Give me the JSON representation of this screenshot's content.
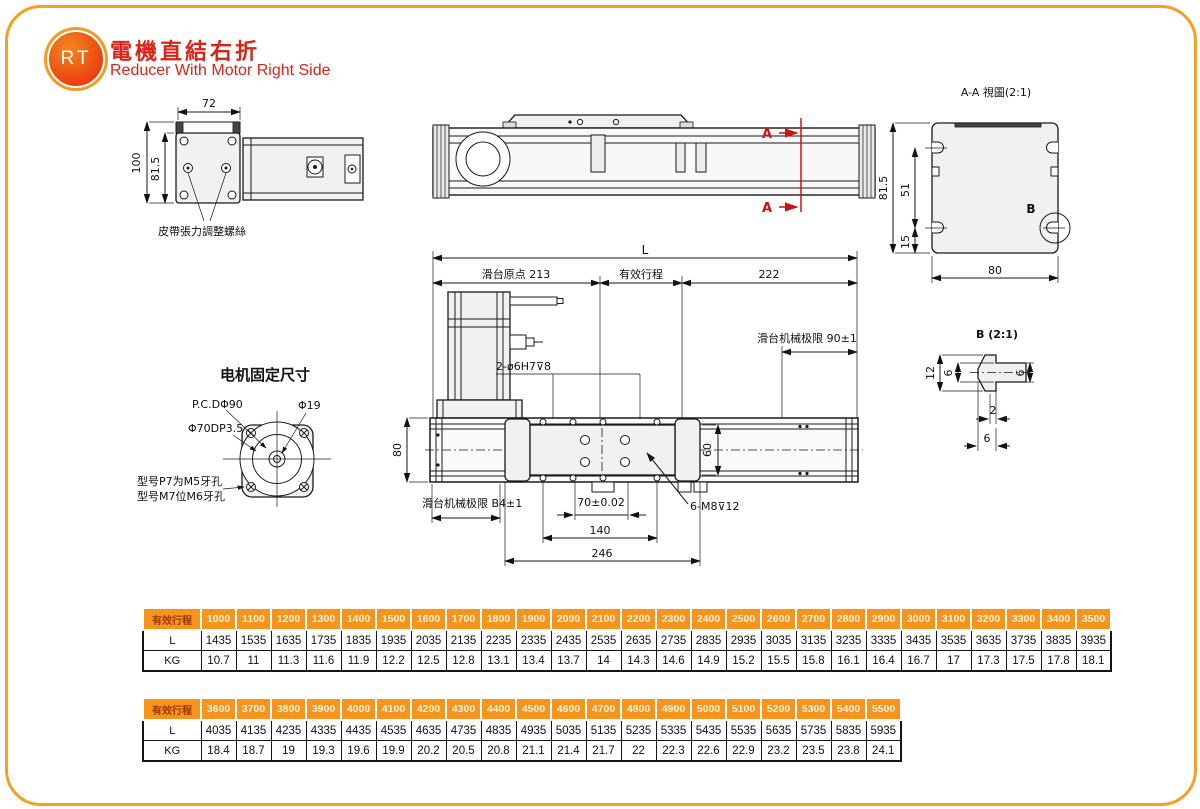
{
  "header": {
    "logo_text": "RT",
    "title_zh": "電機直結右折",
    "title_en": "Reducer With Motor Right Side"
  },
  "drawings": {
    "front": {
      "w": "72",
      "h": "100",
      "h2": "81.5",
      "belt": "皮帶張力調整螺絲"
    },
    "side": {
      "a": "A"
    },
    "aa": {
      "title": "A-A 視圖(2:1)",
      "h": "81.5",
      "d51": "51",
      "d15": "15",
      "w": "80",
      "b": "B"
    },
    "b": {
      "title": "B (2:1)",
      "d12": "12",
      "d6a": "6",
      "d6b": "6",
      "d2": "2",
      "d6c": "6"
    },
    "plan": {
      "L": "L",
      "origin": "滑台原点 213",
      "stroke": "有效行程",
      "d222": "222",
      "limit_right": "滑台机械极限 90±1",
      "limit_left": "滑台机械极限 B4±1",
      "pins": "2-ø6H7⊽8",
      "d80": "80",
      "d60": "60",
      "d70": "70±0.02",
      "d140": "140",
      "d246": "246",
      "screws": "6-M8⊽12"
    },
    "motor": {
      "title": "电机固定尺寸",
      "pcd": "P.C.DΦ90",
      "d19": "Φ19",
      "d70": "Φ70DP3.5",
      "note1": "型号P7为M5牙孔",
      "note2": "型号M7位M6牙孔"
    }
  },
  "tables": [
    {
      "header_label": "有效行程",
      "strokes": [
        "1000",
        "1100",
        "1200",
        "1300",
        "1400",
        "1500",
        "1600",
        "1700",
        "1800",
        "1900",
        "2000",
        "2100",
        "2200",
        "2300",
        "2400",
        "2500",
        "2600",
        "2700",
        "2800",
        "2900",
        "3000",
        "3100",
        "3200",
        "3300",
        "3400",
        "3500"
      ],
      "rows": [
        {
          "label": "L",
          "values": [
            "1435",
            "1535",
            "1635",
            "1735",
            "1835",
            "1935",
            "2035",
            "2135",
            "2235",
            "2335",
            "2435",
            "2535",
            "2635",
            "2735",
            "2835",
            "2935",
            "3035",
            "3135",
            "3235",
            "3335",
            "3435",
            "3535",
            "3635",
            "3735",
            "3835",
            "3935"
          ]
        },
        {
          "label": "KG",
          "values": [
            "10.7",
            "11",
            "11.3",
            "11.6",
            "11.9",
            "12.2",
            "12.5",
            "12.8",
            "13.1",
            "13.4",
            "13.7",
            "14",
            "14.3",
            "14.6",
            "14.9",
            "15.2",
            "15.5",
            "15.8",
            "16.1",
            "16.4",
            "16.7",
            "17",
            "17.3",
            "17.5",
            "17.8",
            "18.1"
          ]
        }
      ]
    },
    {
      "header_label": "有效行程",
      "strokes": [
        "3600",
        "3700",
        "3800",
        "3900",
        "4000",
        "4100",
        "4200",
        "4300",
        "4400",
        "4500",
        "4600",
        "4700",
        "4800",
        "4900",
        "5000",
        "5100",
        "5200",
        "5300",
        "5400",
        "5500"
      ],
      "rows": [
        {
          "label": "L",
          "values": [
            "4035",
            "4135",
            "4235",
            "4335",
            "4435",
            "4535",
            "4635",
            "4735",
            "4835",
            "4935",
            "5035",
            "5135",
            "5235",
            "5335",
            "5435",
            "5535",
            "5635",
            "5735",
            "5835",
            "5935"
          ]
        },
        {
          "label": "KG",
          "values": [
            "18.4",
            "18.7",
            "19",
            "19.3",
            "19.6",
            "19.9",
            "20.2",
            "20.5",
            "20.8",
            "21.1",
            "21.4",
            "21.7",
            "22",
            "22.3",
            "22.6",
            "22.9",
            "23.2",
            "23.5",
            "23.8",
            "24.1"
          ]
        }
      ]
    }
  ]
}
